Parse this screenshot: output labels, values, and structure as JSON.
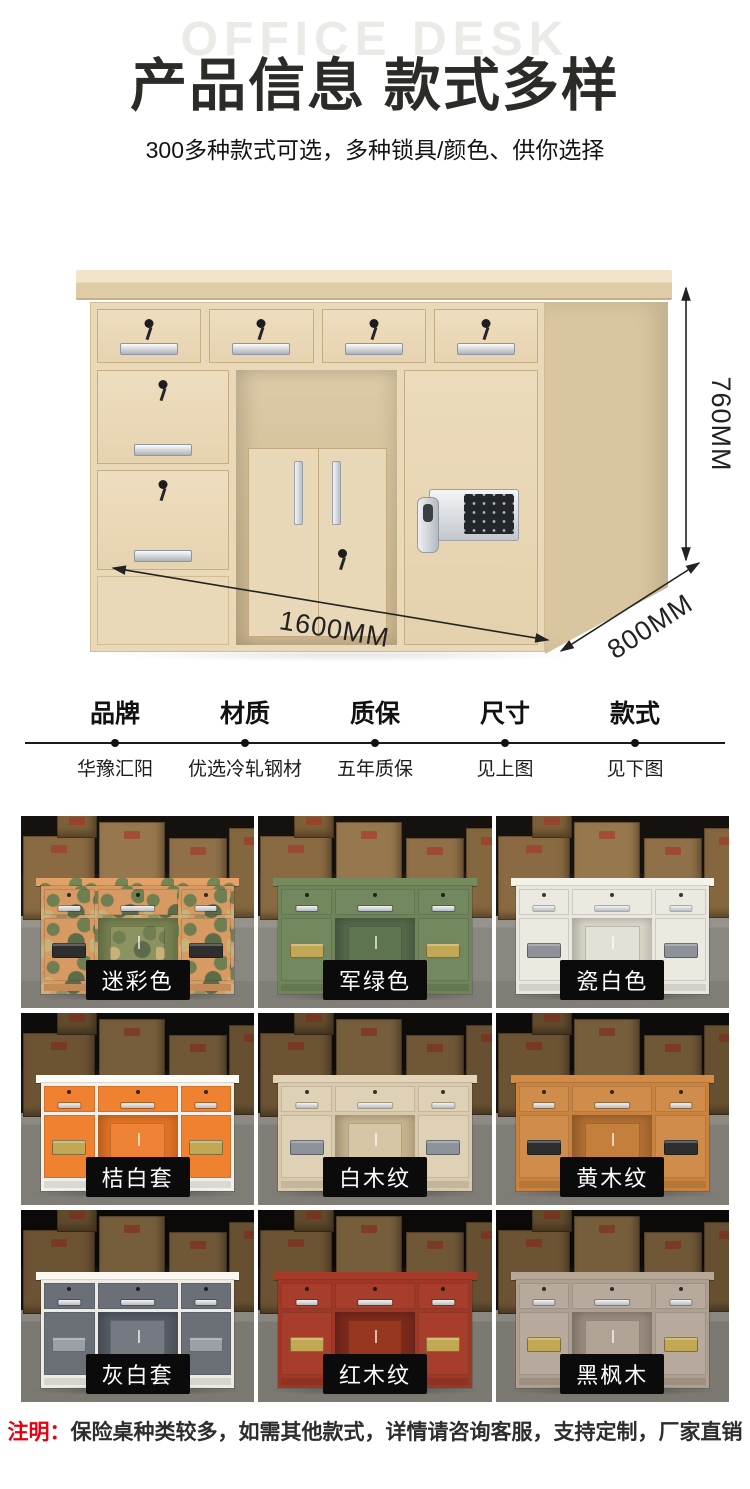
{
  "header": {
    "watermark": "OFFICE DESK",
    "title": "产品信息 款式多样",
    "subtitle": "300多种款式可选，多种锁具/颜色、供你选择"
  },
  "hero": {
    "height_label": "760MM",
    "width_label": "1600MM",
    "depth_label": "800MM"
  },
  "specs": [
    {
      "label": "品牌",
      "value": "华豫汇阳"
    },
    {
      "label": "材质",
      "value": "优选冷轧钢材"
    },
    {
      "label": "质保",
      "value": "五年质保"
    },
    {
      "label": "尺寸",
      "value": "见上图"
    },
    {
      "label": "款式",
      "value": "见下图"
    }
  ],
  "gallery": [
    {
      "label": "迷彩色",
      "camo": true,
      "frame": "#d79a62",
      "face": "#d79a62",
      "open": "#76814f",
      "door": "#8b9360",
      "keypad": "#2e2e2e"
    },
    {
      "label": "军绿色",
      "camo": false,
      "frame": "#6f8459",
      "face": "#74885f",
      "open": "#55684a",
      "door": "#5e7350",
      "keypad": "#c2a855"
    },
    {
      "label": "瓷白色",
      "camo": false,
      "frame": "#e9e7de",
      "face": "#ebe9e0",
      "open": "#d8d5c8",
      "door": "#e3e0d5",
      "keypad": "#8d9298"
    },
    {
      "label": "桔白套",
      "camo": false,
      "frame": "#f2f0ea",
      "face": "#ef8130",
      "open": "#e17323",
      "door": "#ee8335",
      "keypad": "#c2a855"
    },
    {
      "label": "白木纹",
      "camo": false,
      "frame": "#d9caae",
      "face": "#dfd1b5",
      "open": "#c6b38e",
      "door": "#d6c6a6",
      "keypad": "#8d9298"
    },
    {
      "label": "黄木纹",
      "camo": false,
      "frame": "#c98341",
      "face": "#cf8c4a",
      "open": "#b06f33",
      "door": "#c47f3c",
      "keypad": "#2e2e2e"
    },
    {
      "label": "灰白套",
      "camo": false,
      "frame": "#edebe4",
      "face": "#6b7078",
      "open": "#555b64",
      "door": "#757a82",
      "keypad": "#9aa0a6"
    },
    {
      "label": "红木纹",
      "camo": false,
      "frame": "#9e3726",
      "face": "#a63e2b",
      "open": "#7c2a1c",
      "door": "#98371f",
      "keypad": "#c2a855"
    },
    {
      "label": "黑枫木",
      "camo": false,
      "frame": "#ae9f90",
      "face": "#b7a99b",
      "open": "#998b7e",
      "door": "#b0a294",
      "keypad": "#c2a855"
    }
  ],
  "footer": {
    "prefix": "注明：",
    "text": "保险桌种类较多，如需其他款式，详情请咨询客服，支持定制，厂家直销"
  },
  "colors": {
    "accent_red": "#e60012",
    "title_text": "#2b2b27",
    "watermark": "#ebeae6",
    "tag_bg": "#0b0b0b"
  }
}
